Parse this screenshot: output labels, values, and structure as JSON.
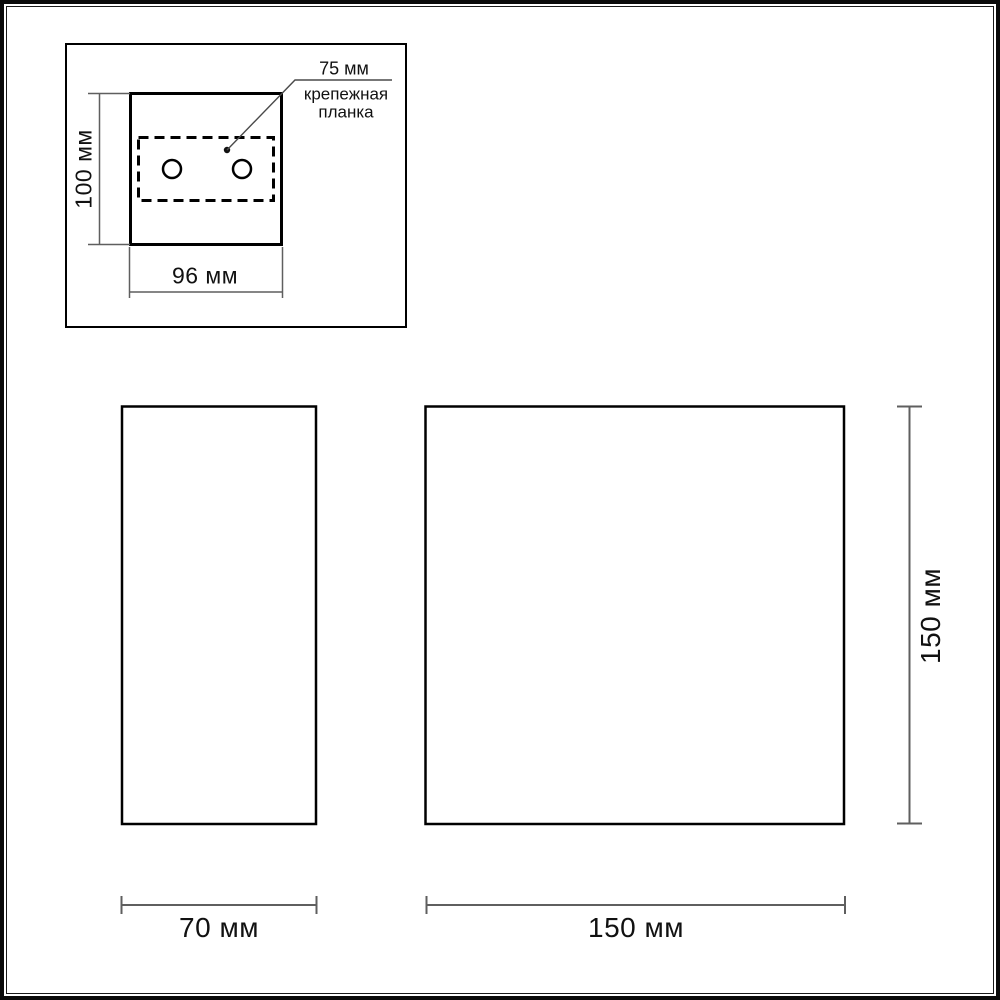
{
  "drawing": {
    "colors": {
      "outline": "#000000",
      "dimension_line": "#5f5f5f",
      "leader_line": "#4a4a4a",
      "text": "#111111"
    },
    "inset": {
      "height_label": "100 мм",
      "width_label": "96 мм",
      "mounting_plate": {
        "dimension_label": "75 мм",
        "name_line1": "крепежная",
        "name_line2": "планка"
      }
    },
    "side_view": {
      "width_label": "70 мм"
    },
    "front_view": {
      "width_label": "150 мм",
      "height_label": "150 мм"
    }
  }
}
